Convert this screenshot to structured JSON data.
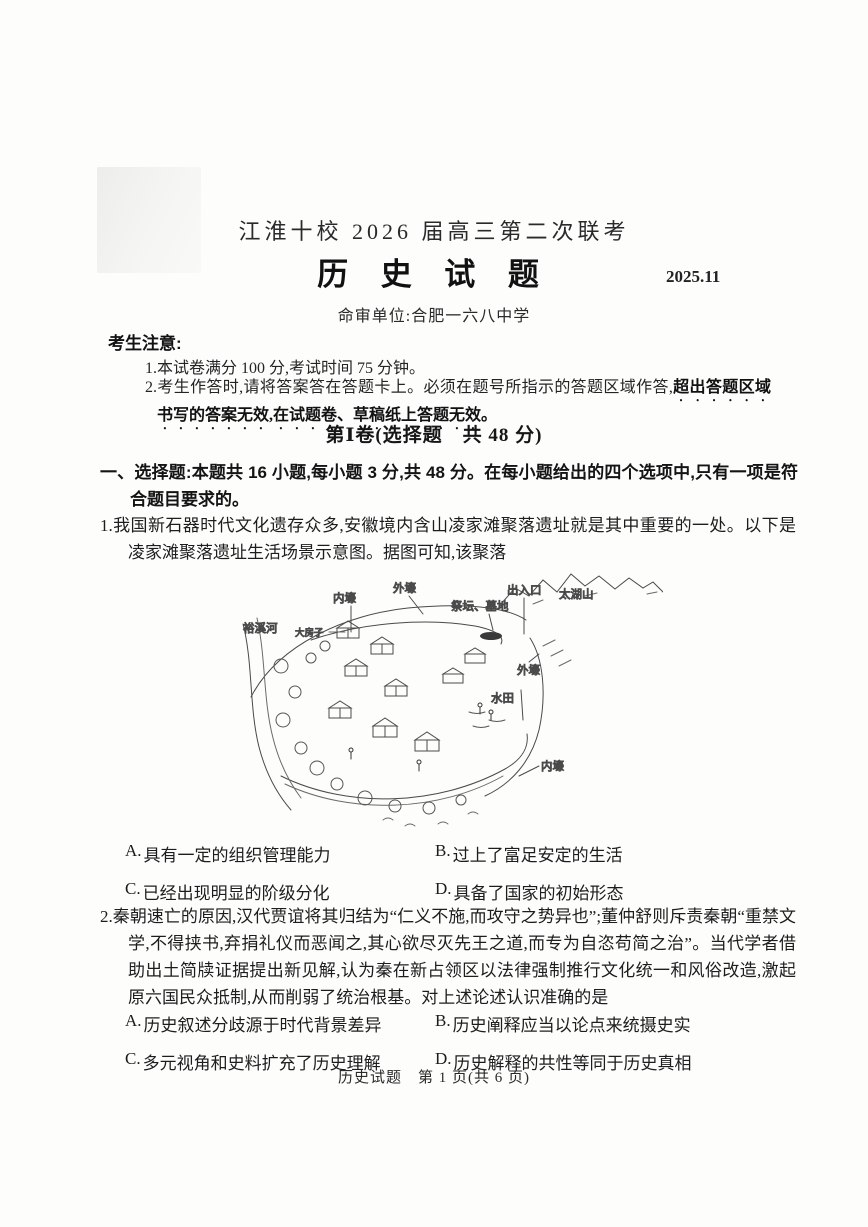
{
  "header": {
    "exam_series": "江淮十校 2026 届高三第二次联考",
    "subject": "历 史 试 题",
    "date": "2025.11",
    "issuer": "命审单位:合肥一六八中学"
  },
  "notice": {
    "title": "考生注意:",
    "item1": "1.本试卷满分 100 分,考试时间 75 分钟。",
    "item2_normal": "2.考生作答时,请将答案答在答题卡上。必须在题号所指示的答题区域作答,",
    "item2_emphasis": "超出答题区域书写的答案无效,在试题卷、草稿纸上答题无效。"
  },
  "section1": {
    "title": "第Ⅰ卷(选择题　共 48 分)",
    "intro": "一、选择题:本题共 16 小题,每小题 3 分,共 48 分。在每小题给出的四个选项中,只有一项是符合题目要求的。"
  },
  "questions": [
    {
      "stem": "1.我国新石器时代文化遗存众多,安徽境内含山凌家滩聚落遗址就是其中重要的一处。以下是凌家滩聚落遗址生活场景示意图。据图可知,该聚落",
      "options": [
        {
          "label": "A.",
          "text": "具有一定的组织管理能力"
        },
        {
          "label": "B.",
          "text": "过上了富足安定的生活"
        },
        {
          "label": "C.",
          "text": "已经出现明显的阶级分化"
        },
        {
          "label": "D.",
          "text": "具备了国家的初始形态"
        }
      ]
    },
    {
      "stem": "2.秦朝速亡的原因,汉代贾谊将其归结为“仁义不施,而攻守之势异也”;董仲舒则斥责秦朝“重禁文学,不得挟书,弃捐礼仪而恶闻之,其心欲尽灭先王之道,而专为自恣苟简之治”。当代学者借助出土简牍证据提出新见解,认为秦在新占领区以法律强制推行文化统一和风俗改造,激起原六国民众抵制,从而削弱了统治根基。对上述论述认识准确的是",
      "options": [
        {
          "label": "A.",
          "text": "历史叙述分歧源于时代背景差异"
        },
        {
          "label": "B.",
          "text": "历史阐释应当以论点来统摄史实"
        },
        {
          "label": "C.",
          "text": "多元视角和史料扩充了历史理解"
        },
        {
          "label": "D.",
          "text": "历史解释的共性等同于历史真相"
        }
      ]
    }
  ],
  "figure": {
    "labels": [
      {
        "text": "内壕"
      },
      {
        "text": "外壕"
      },
      {
        "text": "祭坛、墓地"
      },
      {
        "text": "出入口"
      },
      {
        "text": "太湖山"
      },
      {
        "text": "裕溪河"
      },
      {
        "text": "大房子"
      },
      {
        "text": "外壕"
      },
      {
        "text": "水田"
      },
      {
        "text": "内壕"
      }
    ]
  },
  "footer": {
    "text": "历史试题　第 1 页(共 6 页)"
  }
}
